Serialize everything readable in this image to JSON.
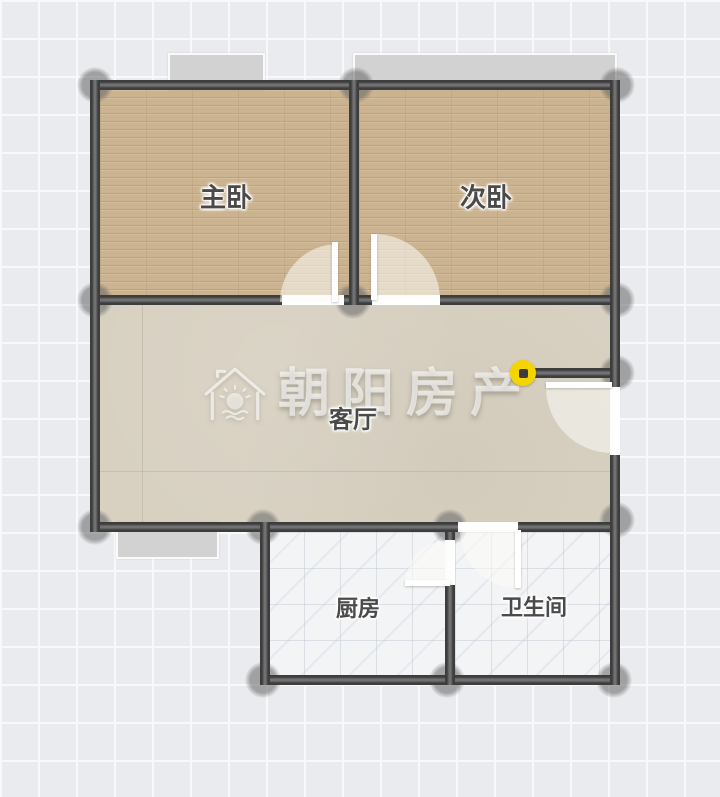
{
  "canvas": {
    "width": 720,
    "height": 797,
    "kind": "residential floor plan"
  },
  "watermark": {
    "brand_text": "朝阳房产",
    "logo_icon": "house-sunrise-logo"
  },
  "rooms": {
    "master_bedroom": {
      "label": "主卧"
    },
    "second_bedroom": {
      "label": "次卧"
    },
    "living_room": {
      "label": "客厅"
    },
    "kitchen": {
      "label": "厨房"
    },
    "bathroom": {
      "label": "卫生间"
    }
  },
  "markers": {
    "entry_point": {
      "icon": "yellow-dot-marker",
      "color": "#F5D500"
    }
  },
  "colors": {
    "wall": "#3F3F3F",
    "wall_highlight": "#717171",
    "wood_floor": "#CCB390",
    "living_floor": "#D8D1C2",
    "tile_floor": "#F3F4F6",
    "window_fill": "#D2D2D2",
    "door_leaf": "#FFFFFF",
    "background_grid": "#E9EBEE",
    "accent_yellow": "#F5D500",
    "label_text": "#4A4A4A"
  }
}
